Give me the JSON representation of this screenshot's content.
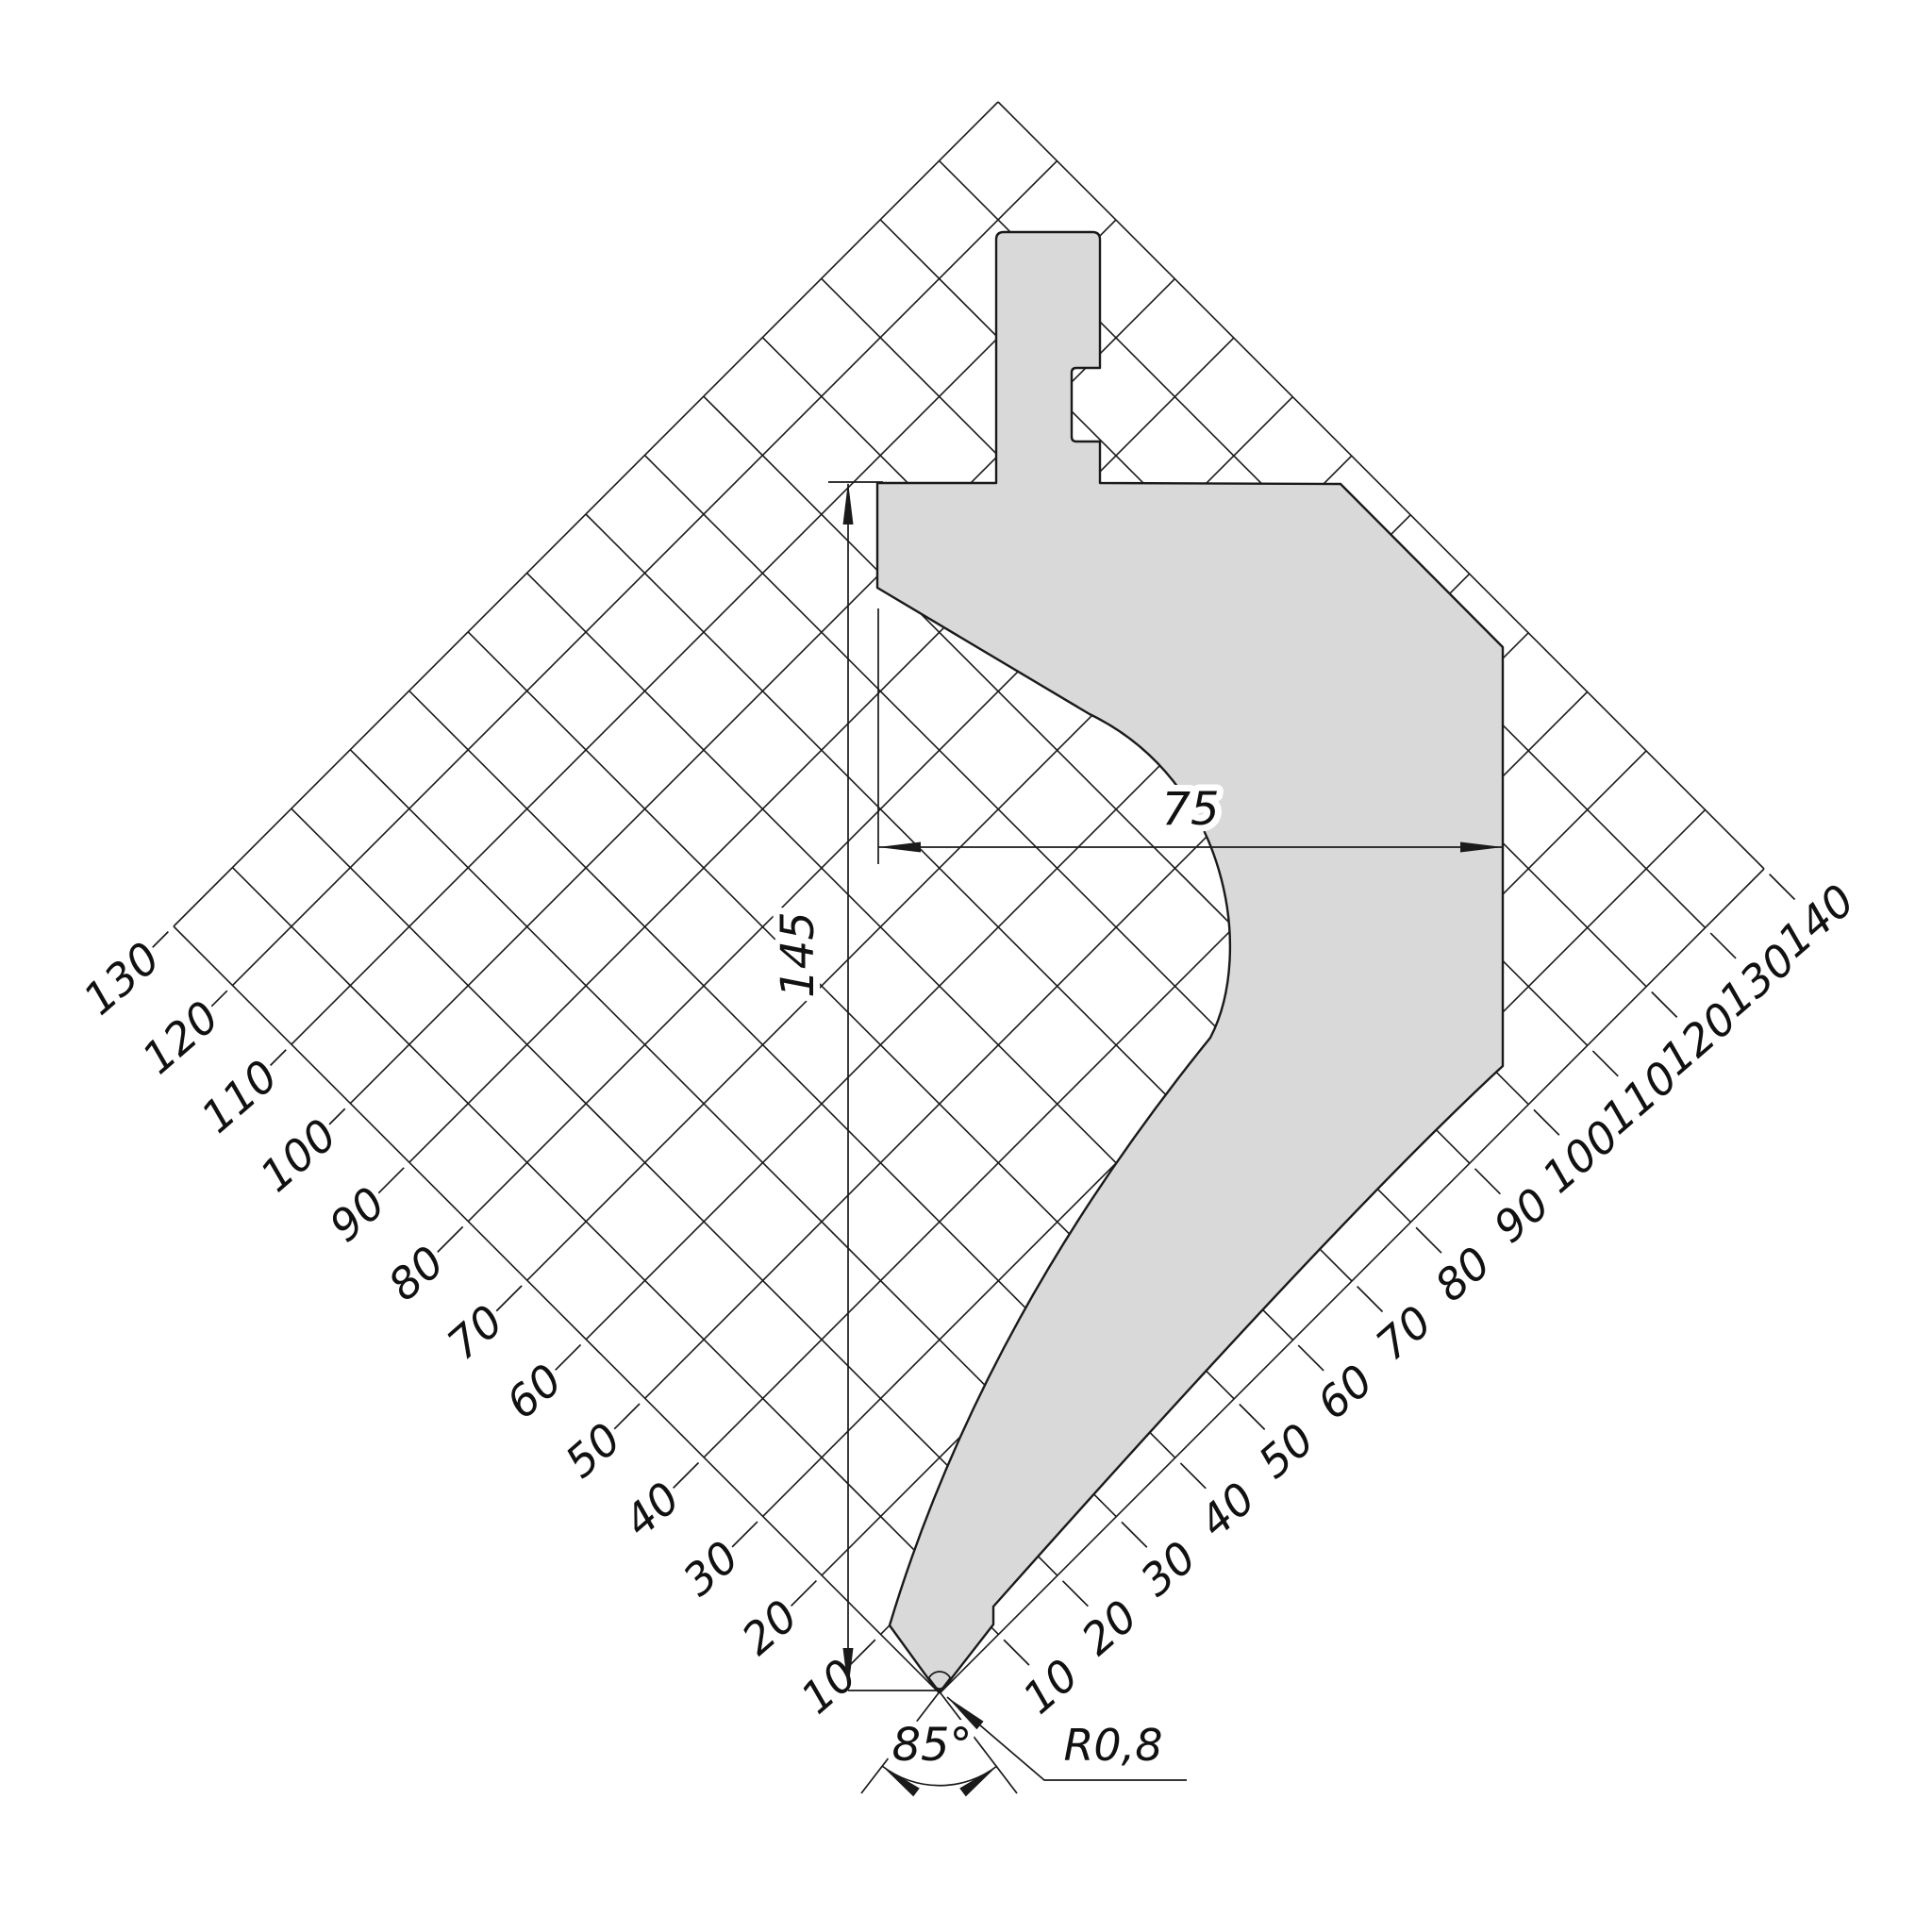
{
  "drawing": {
    "dimensions": {
      "width": {
        "label": "75"
      },
      "height": {
        "label": "145"
      },
      "tip_angle": {
        "label": "85°"
      },
      "tip_radius": {
        "label": "R0,8"
      }
    },
    "ruler": {
      "left_labels": [
        "130",
        "120",
        "110",
        "100",
        "90",
        "80",
        "70",
        "60",
        "50",
        "40",
        "30",
        "20",
        "10"
      ],
      "right_labels": [
        "10",
        "20",
        "30",
        "40",
        "50",
        "60",
        "70",
        "80",
        "90",
        "100",
        "110",
        "120",
        "130",
        "140"
      ]
    },
    "colors": {
      "background": "#ffffff",
      "part_fill": "#d9d9d9",
      "line_color": "#1a1a1a"
    }
  }
}
